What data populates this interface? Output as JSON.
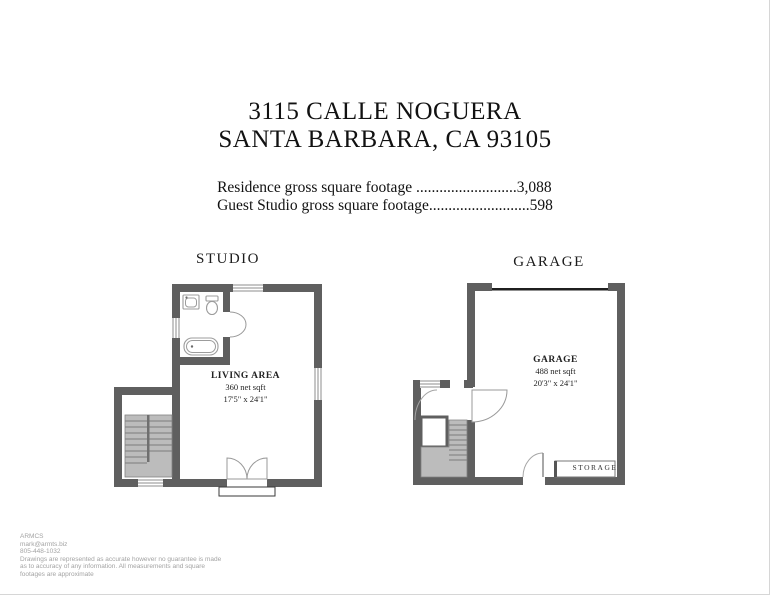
{
  "header": {
    "address_line1": "3115 CALLE NOGUERA",
    "address_line2": "SANTA BARBARA, CA 93105",
    "footage_lines": [
      "Residence gross square footage ..........................3,088",
      "Guest Studio gross square footage..........................598"
    ]
  },
  "plans": {
    "studio": {
      "title": "STUDIO",
      "room": {
        "name": "LIVING AREA",
        "area": "360 net sqft",
        "dims": "17'5\" x 24'1\""
      }
    },
    "garage": {
      "title": "GARAGE",
      "room": {
        "name": "GARAGE",
        "area": "488 net sqft",
        "dims": "20'3\" x 24'1\""
      },
      "storage_label": "STORAGE"
    }
  },
  "footer": {
    "company": "ARMCS",
    "email": "mark@armts.biz",
    "phone": "805-448-1032",
    "disclaimer_lines": [
      "Drawings are represented as accurate however no guarantee is made",
      "as to accuracy of any information. All measurements and square",
      "footages are approximate"
    ]
  },
  "colors": {
    "wall": "#5f5f5f",
    "stair": "#bcbcbc",
    "text": "#1b1b1b",
    "footer": "#a3a3a3"
  }
}
